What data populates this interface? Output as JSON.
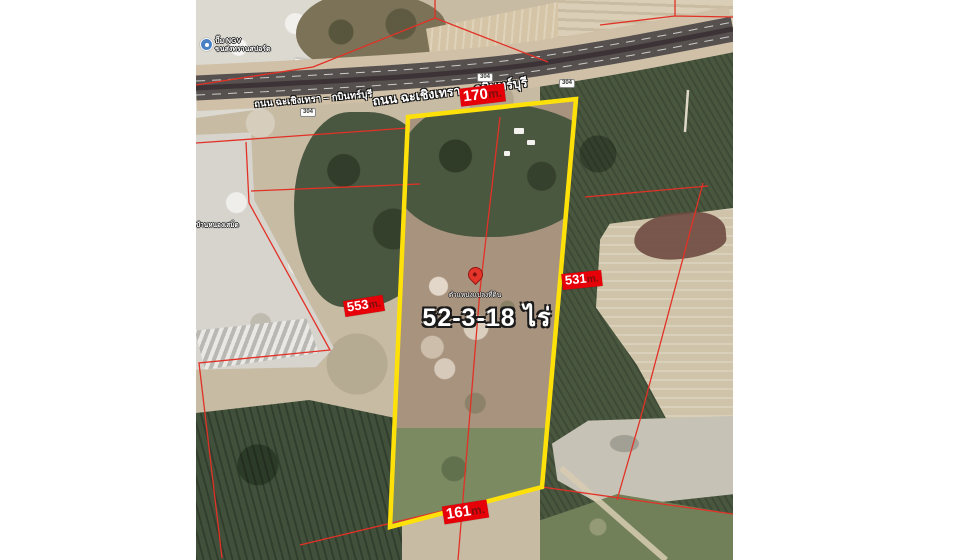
{
  "map": {
    "road": {
      "name": "ถนน ฉะเชิงเทรา – กบินทร์บุรี",
      "route_number": "304"
    },
    "poi": {
      "line1": "ปั๊ม NGV",
      "line2": "ขนส่งทรานสปอร์ต"
    },
    "place_label": "บ้านหนองเสม็ด",
    "pin": {
      "caption": "ตำแหน่งแปลงที่ดิน"
    },
    "area": {
      "value": "52-3-18",
      "unit": "ไร่"
    },
    "measurements": {
      "top": {
        "value": "170",
        "unit": "m."
      },
      "left": {
        "value": "553",
        "unit": "m."
      },
      "right": {
        "value": "531",
        "unit": "m."
      },
      "bottom": {
        "value": "161",
        "unit": "m."
      }
    },
    "colors": {
      "plot_outline": "#ffe10a",
      "parcel_line": "#e23126",
      "measurement_bg": "#e60008",
      "measurement_text": "#ffffff",
      "measurement_unit": "#7f0d0d",
      "pin": "#e5352b",
      "road_asphalt": "#56514f",
      "background": "#ffffff"
    }
  }
}
